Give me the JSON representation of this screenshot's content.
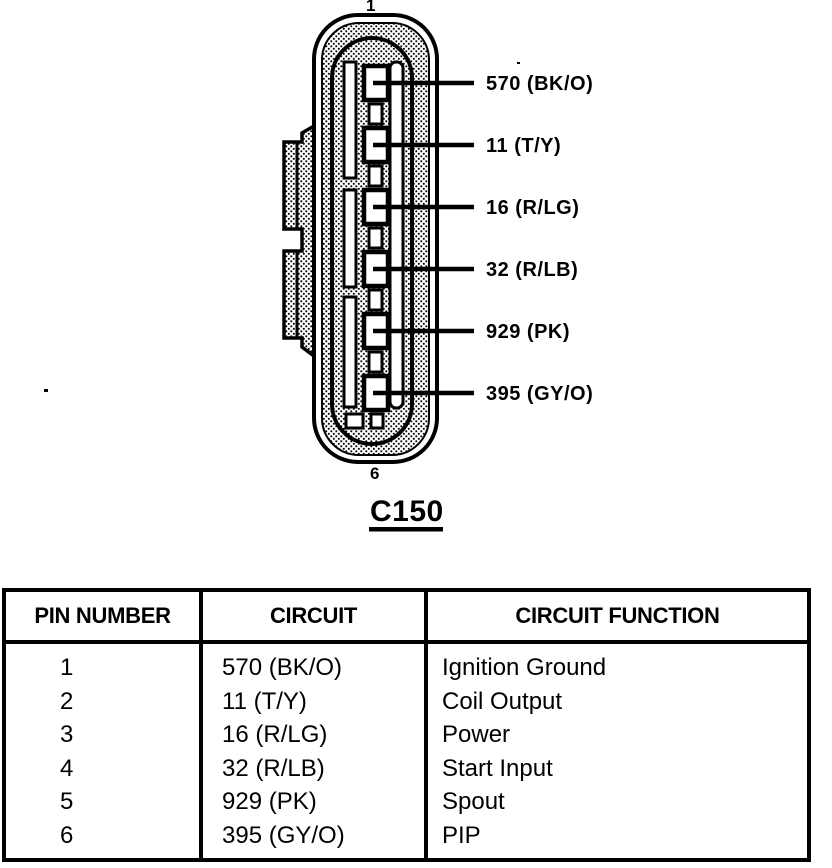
{
  "diagram": {
    "top_pin_number": "1",
    "bottom_pin_number": "6",
    "connector_id": "C150",
    "pin_labels": [
      "570 (BK/O)",
      "11 (T/Y)",
      "16 (R/LG)",
      "32 (R/LB)",
      "929 (PK)",
      "395 (GY/O)"
    ]
  },
  "table": {
    "headers": [
      "PIN NUMBER",
      "CIRCUIT",
      "CIRCUIT FUNCTION"
    ],
    "rows": [
      {
        "pin": "1",
        "circuit": "570 (BK/O)",
        "function": "Ignition Ground"
      },
      {
        "pin": "2",
        "circuit": "11 (T/Y)",
        "function": "Coil Output"
      },
      {
        "pin": "3",
        "circuit": "16 (R/LG)",
        "function": "Power"
      },
      {
        "pin": "4",
        "circuit": "32 (R/LB)",
        "function": "Start Input"
      },
      {
        "pin": "5",
        "circuit": "929 (PK)",
        "function": "Spout"
      },
      {
        "pin": "6",
        "circuit": "395 (GY/O)",
        "function": "PIP"
      }
    ]
  },
  "colors": {
    "ink": "#000000",
    "paper": "#ffffff"
  }
}
